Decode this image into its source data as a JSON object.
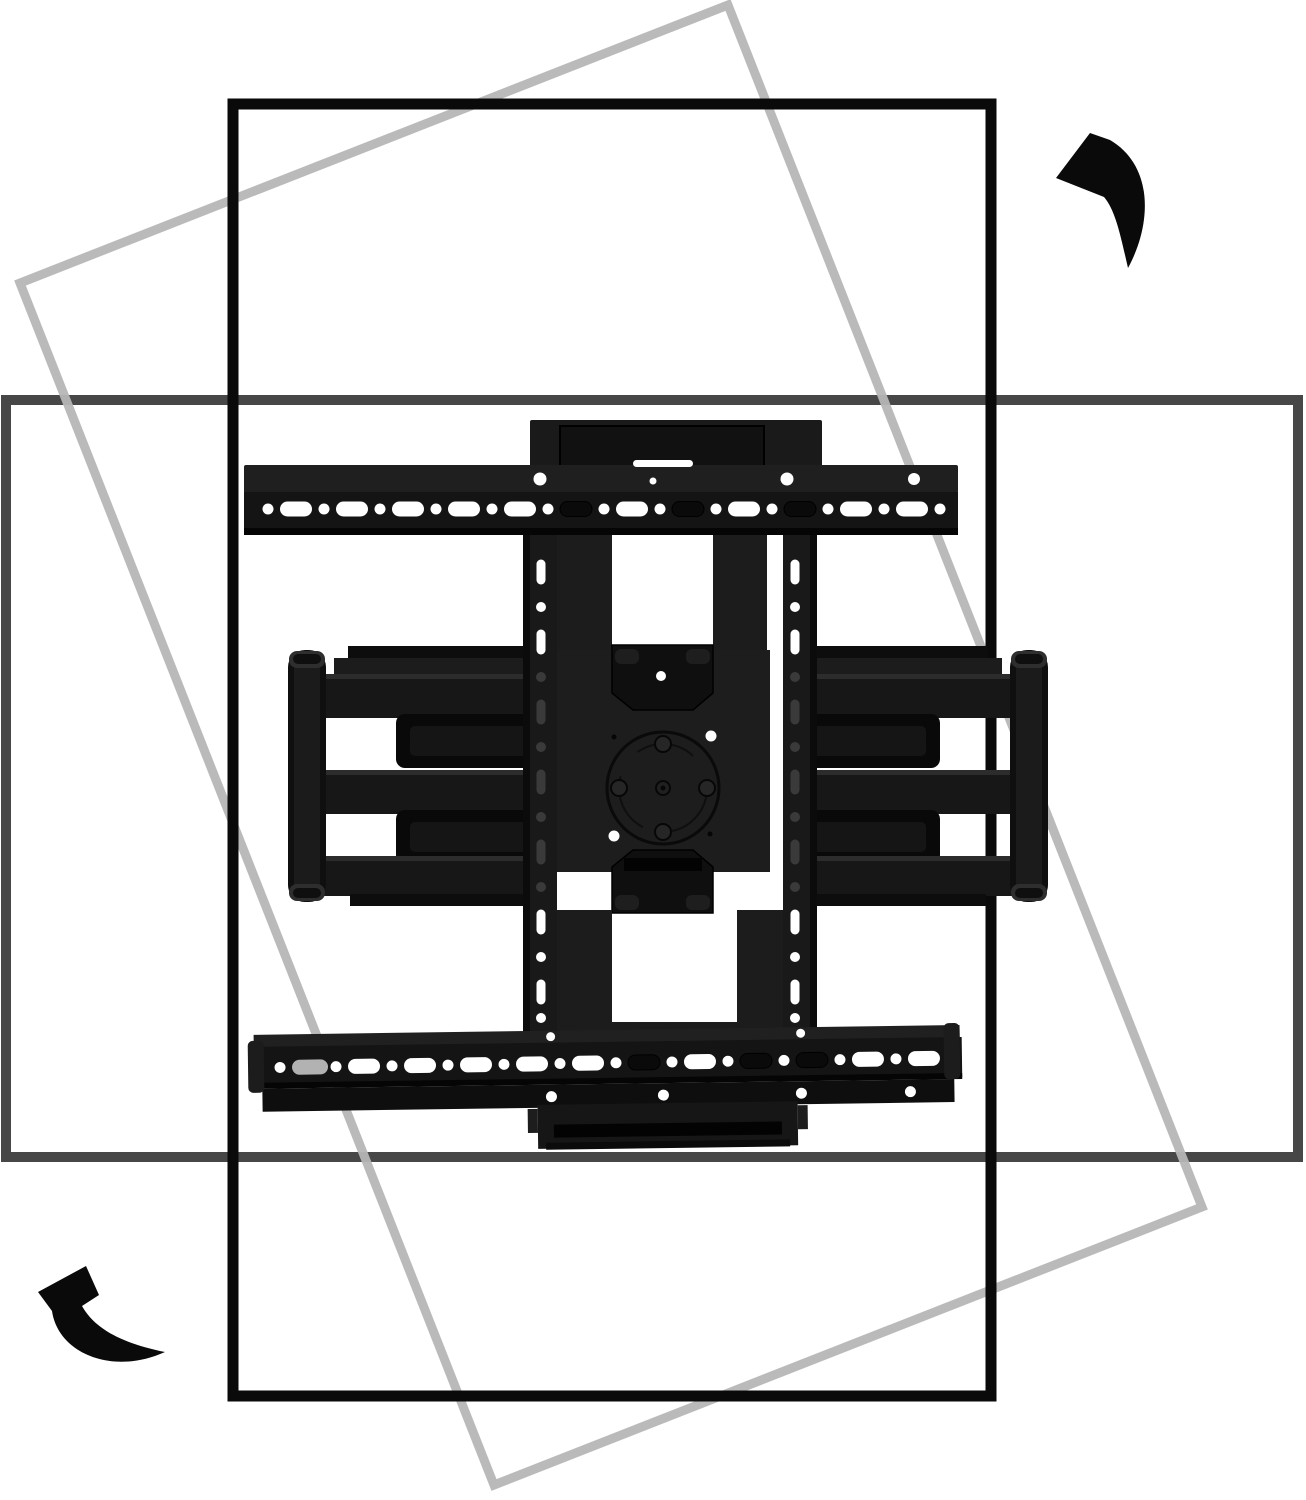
{
  "page": {
    "title": "Full-motion TV wall mount rotation illustration",
    "background": "#ffffff"
  },
  "colors": {
    "portrait_frame": "#0a0a0a",
    "landscape_frame": "#474747",
    "rotated_frame": "#b6b6b6",
    "arrow": "#0a0a0a",
    "mount_dark": "#141414",
    "mount_plate": "#1d1d1d",
    "hole_white": "#ffffff"
  },
  "illustration": {
    "frames": [
      {
        "name": "portrait-tv-outline",
        "color": "#0a0a0a",
        "rotation_deg": 0
      },
      {
        "name": "landscape-tv-outline",
        "color": "#474747",
        "rotation_deg": 0
      },
      {
        "name": "rotated-tv-outline",
        "color": "#b6b6b6",
        "rotation_deg": 21
      }
    ],
    "arrows": [
      {
        "name": "rotate-arrow-top-right",
        "meaning": "counterclockwise-rotation"
      },
      {
        "name": "rotate-arrow-bottom-left",
        "meaning": "counterclockwise-rotation"
      }
    ],
    "mount_parts": [
      "top-tv-bracket-rail",
      "bottom-tv-bracket-rail",
      "wall-plate-top-stub",
      "vesa-rail-left",
      "vesa-rail-right",
      "center-swivel-plate",
      "articulating-arm-left",
      "articulating-arm-right",
      "hinge-posts",
      "mounting-slots",
      "screw-holes"
    ]
  }
}
